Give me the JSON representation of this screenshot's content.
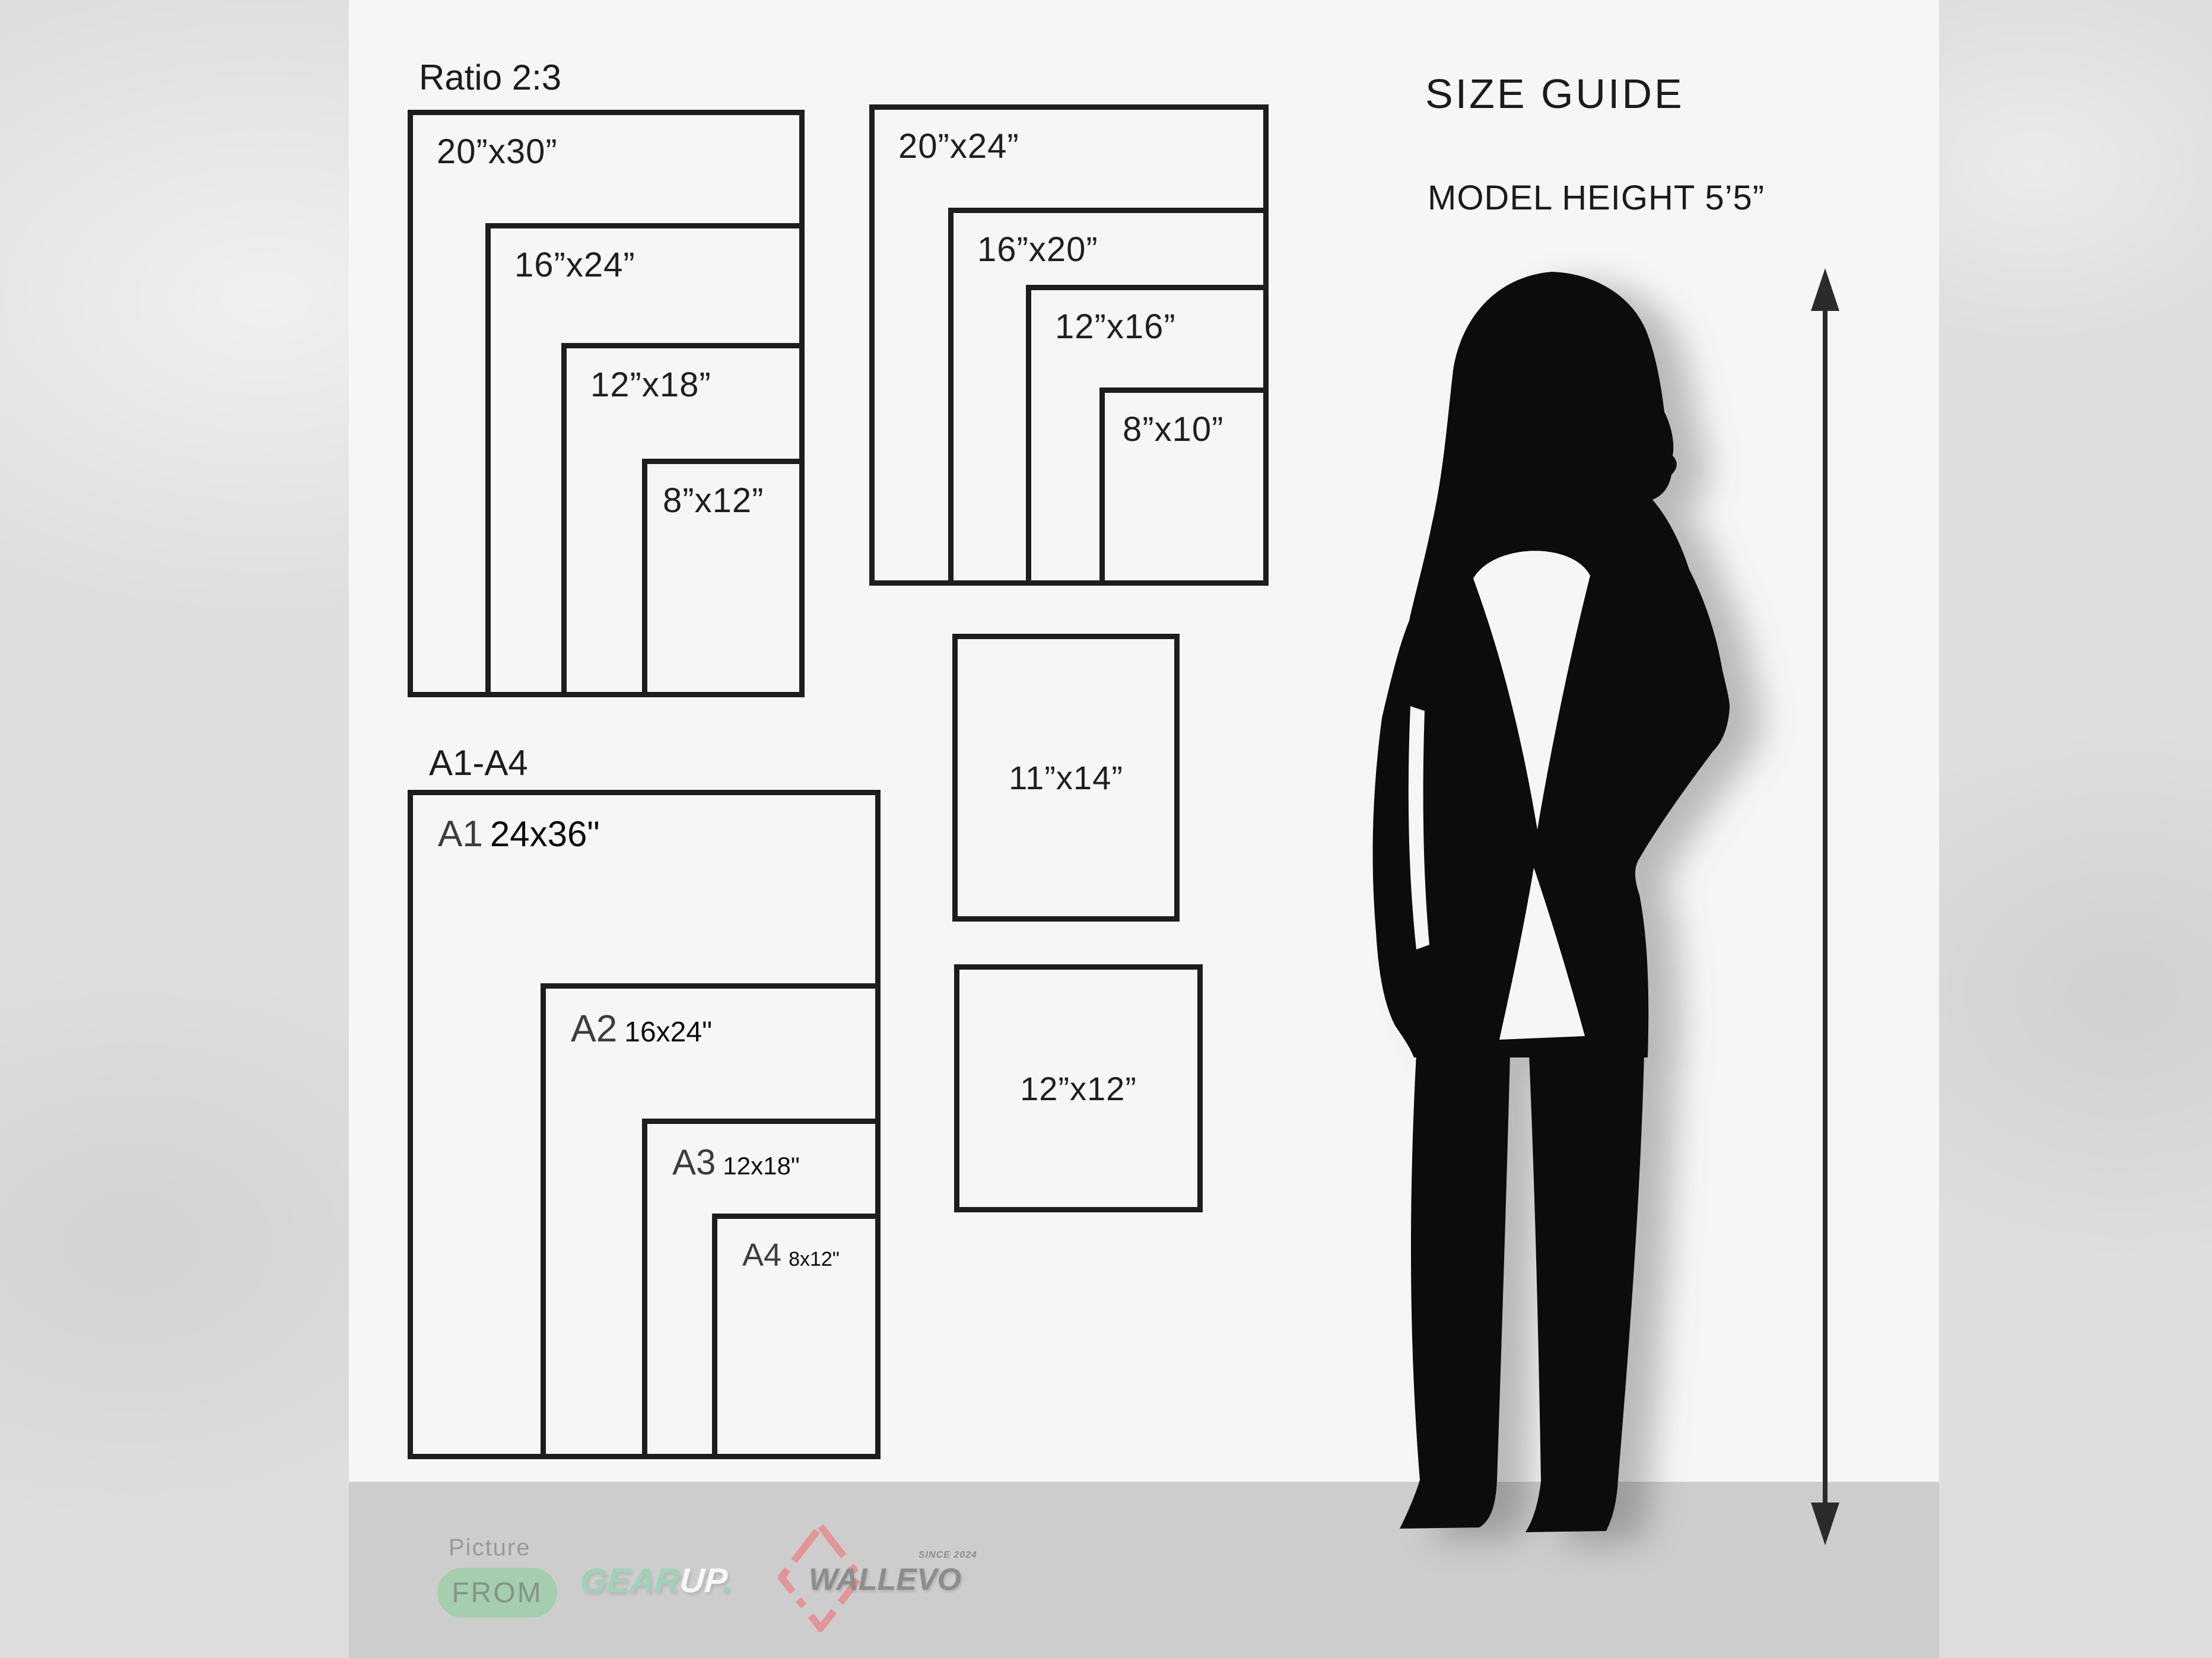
{
  "colors": {
    "panel_bg": "#f6f6f5",
    "outer_bg": "#e0dedc",
    "footer_band": "#cecdcd",
    "frame_border": "#1d1d1d",
    "text_dark": "#1b1b1b",
    "pill_green": "#a4ceae",
    "mint_green": "#9ed3b8",
    "logo_gray": "#8d8d8d",
    "diamond_coral": "#e39597",
    "silhouette_black": "#0c0c0c"
  },
  "ratio_group": {
    "title": "Ratio 2:3",
    "frames": [
      {
        "label": "20”x30”"
      },
      {
        "label": "16”x24”"
      },
      {
        "label": "12”x18”"
      },
      {
        "label": "8”x12”"
      }
    ]
  },
  "standard_group": {
    "frames": [
      {
        "label": "20”x24”"
      },
      {
        "label": "16”x20”"
      },
      {
        "label": "12”x16”"
      },
      {
        "label": "8”x10”"
      }
    ]
  },
  "a_group": {
    "title": "A1-A4",
    "frames": [
      {
        "prefix": "A1",
        "size": "24x36\""
      },
      {
        "prefix": "A2",
        "size": "16x24\""
      },
      {
        "prefix": "A3",
        "size": "12x18\""
      },
      {
        "prefix": "A4",
        "size": "8x12\""
      }
    ]
  },
  "single_frames": [
    {
      "label": "11”x14”"
    },
    {
      "label": "12”x12”"
    }
  ],
  "size_guide": {
    "title": "SIZE GUIDE",
    "model_height": "MODEL HEIGHT 5’5”"
  },
  "footer": {
    "picture_label": "Picture",
    "from_label": "FROM",
    "gearup": {
      "gear": "GEAR",
      "up": "UP",
      "dot": "."
    },
    "wallevo": {
      "name": "WALLEVO",
      "since": "SINCE 2024"
    }
  }
}
